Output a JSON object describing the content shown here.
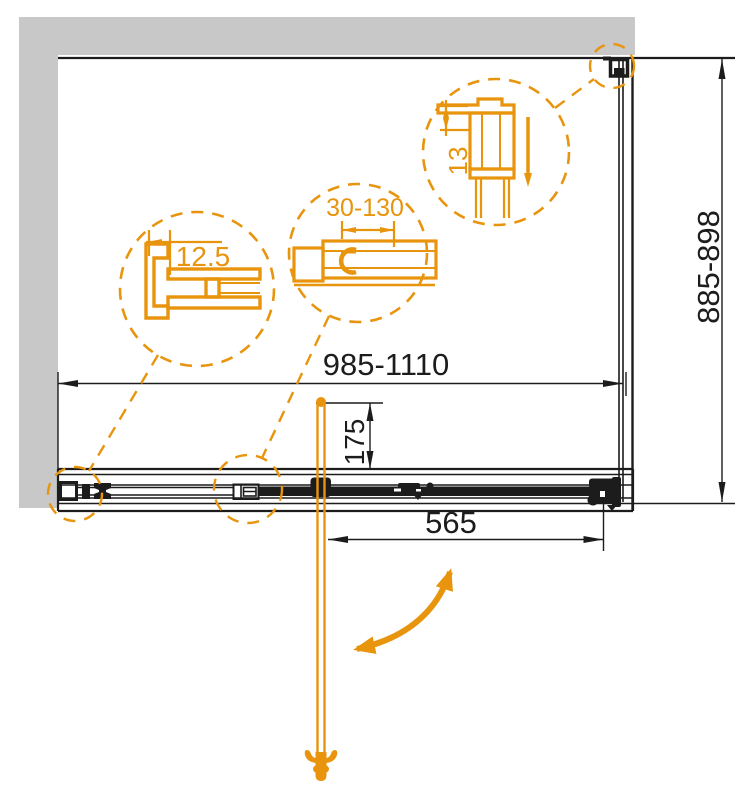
{
  "drawing": {
    "colors": {
      "accent": "#E8940D",
      "wall": "#C8C8C8",
      "line": "#1C1C1C"
    },
    "dimensions": {
      "overall_width": "985-1110",
      "side_depth": "885-898",
      "door_width": "565",
      "handle_offset": "175"
    },
    "details": {
      "wall_profile": "12.5",
      "adjustment_range": "30-130",
      "top_profile": "13"
    },
    "icons": {
      "swing_arrow": "curved-double-arrow",
      "detail_circle": "dashed-zoom-circle",
      "handle_foot": "finial-ornament"
    }
  }
}
